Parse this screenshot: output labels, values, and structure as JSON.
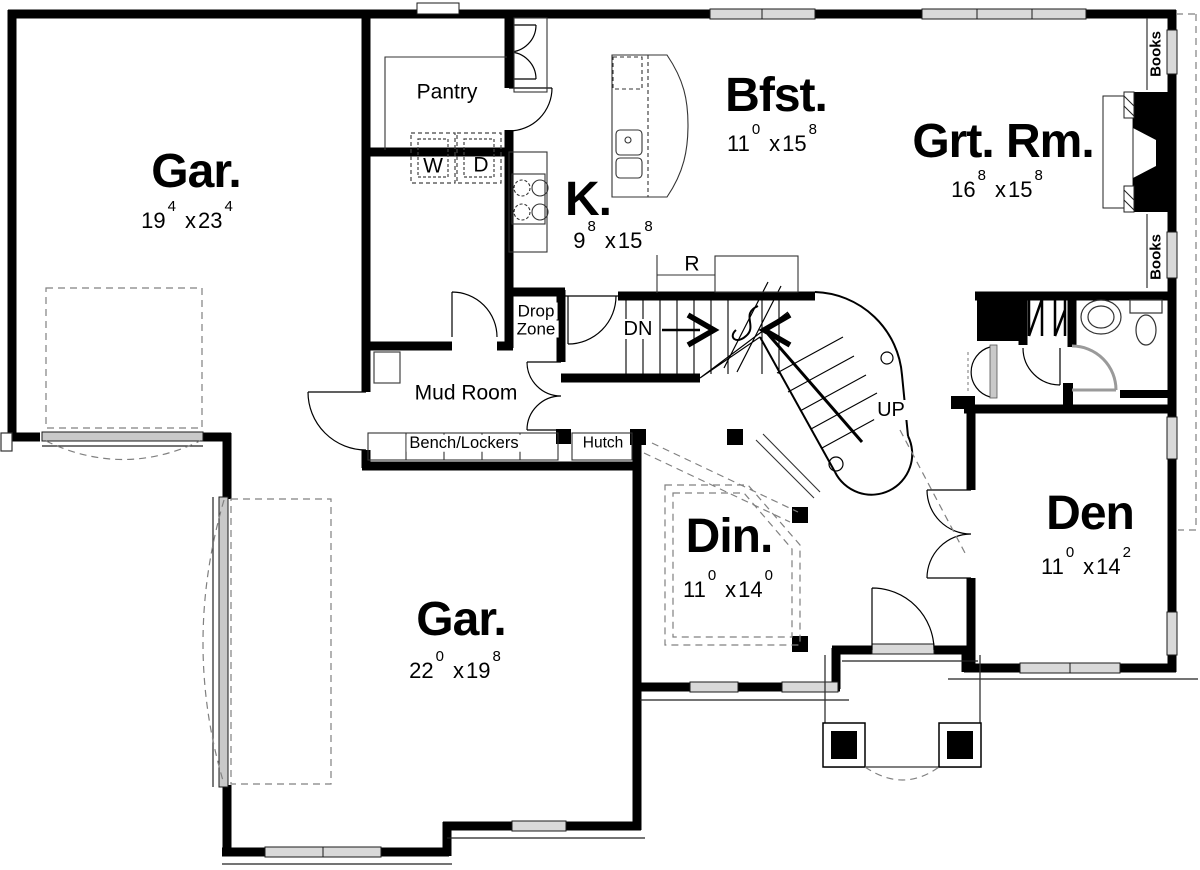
{
  "rooms": [
    {
      "id": "garage-top",
      "label": "Gar.",
      "dim": {
        "a": "19",
        "asup": "4",
        "sep": "x",
        "b": "23",
        "bsup": "4"
      }
    },
    {
      "id": "pantry",
      "label": "Pantry"
    },
    {
      "id": "kitchen",
      "label": "K.",
      "dim": {
        "a": "9",
        "asup": "8",
        "sep": "x",
        "b": "15",
        "bsup": "8"
      }
    },
    {
      "id": "breakfast",
      "label": "Bfst.",
      "dim": {
        "a": "11",
        "asup": "0",
        "sep": "x",
        "b": "15",
        "bsup": "8"
      }
    },
    {
      "id": "great-room",
      "label": "Grt. Rm.",
      "dim": {
        "a": "16",
        "asup": "8",
        "sep": "x",
        "b": "15",
        "bsup": "8"
      }
    },
    {
      "id": "mud-room",
      "label": "Mud Room"
    },
    {
      "id": "dining",
      "label": "Din.",
      "dim": {
        "a": "11",
        "asup": "0",
        "sep": "x",
        "b": "14",
        "bsup": "0"
      }
    },
    {
      "id": "den",
      "label": "Den",
      "dim": {
        "a": "11",
        "asup": "0",
        "sep": "x",
        "b": "14",
        "bsup": "2"
      }
    },
    {
      "id": "garage-bottom",
      "label": "Gar.",
      "dim": {
        "a": "22",
        "asup": "0",
        "sep": "x",
        "b": "19",
        "bsup": "8"
      }
    }
  ],
  "labels": {
    "washer": "W",
    "dryer": "D",
    "refrigerator": "R",
    "down": "DN",
    "up": "UP",
    "drop_zone_line1": "Drop",
    "drop_zone_line2": "Zone",
    "bench_lockers": "Bench/Lockers",
    "hutch": "Hutch",
    "books_upper": "Books",
    "books_lower": "Books"
  },
  "colors": {
    "wall": "#000000",
    "window_fill": "#d9d9d9",
    "door_sill": "#c9c9c9",
    "dashed_line": "#808080",
    "background": "#ffffff"
  }
}
